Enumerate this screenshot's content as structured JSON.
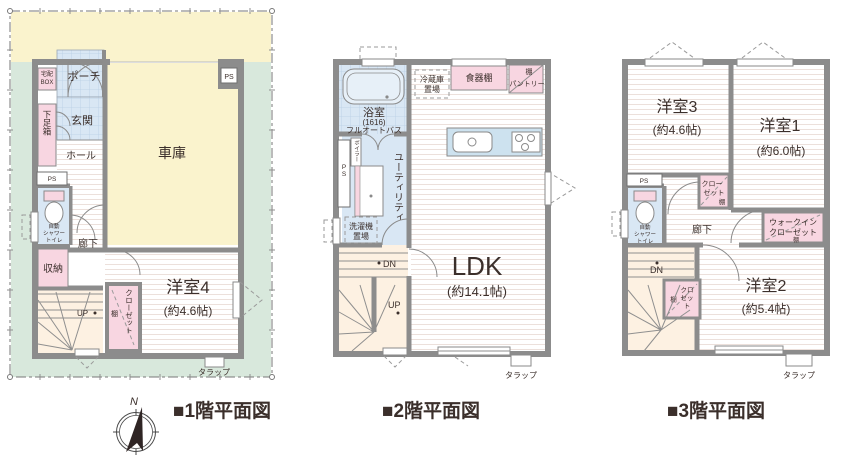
{
  "page": {
    "type": "floor-plan-sheet",
    "background": "#ffffff"
  },
  "colors": {
    "yard_yellow": "#faf3cd",
    "yard_green": "#d8e8dc",
    "garage_yellow": "#faf3cd",
    "tile_blue": "#d9e7f4",
    "fixture_blue": "#cde2ef",
    "pink": "#f8d6e1",
    "stair_cream": "#fdf1e2",
    "wall_gray": "#8c8c8c",
    "text_dark": "#3b2f2b"
  },
  "captions": {
    "floor1": "■1階平面図",
    "floor2": "■2階平面図",
    "floor3": "■3階平面図"
  },
  "compass": {
    "north_label": "N"
  },
  "floor1": {
    "labels": {
      "delivery_l1": "宅配",
      "delivery_l2": "BOX",
      "porch": "ポーチ",
      "entrance": "玄関",
      "shoe_cabinet": "下足箱",
      "hall": "ホール",
      "ps_garage": "PS",
      "garage": "車庫",
      "ps_left": "PS",
      "toilet_l1": "自動",
      "toilet_l2": "シャワー",
      "toilet_l3": "トイレ",
      "corridor": "廊下",
      "storage": "収納",
      "up": "UP",
      "closet": "クローゼット",
      "closet_shelf": "棚",
      "room4": "洋室4",
      "room4_size": "(約4.6帖)",
      "tarappu": "タラップ"
    }
  },
  "floor2": {
    "labels": {
      "bath": "浴室",
      "bath_size": "(1616)",
      "bath_type": "フルオートバス",
      "fridge_l1": "冷蔵庫",
      "fridge_l2": "置場",
      "cupboard": "食器棚",
      "shelf": "棚",
      "pantry": "パントリー",
      "boiler": "ボイラー",
      "ps": "PS",
      "utility": "ユーティリティ",
      "washer_l1": "洗濯機",
      "washer_l2": "置場",
      "dn": "DN",
      "up": "UP",
      "ldk": "LDK",
      "ldk_size": "(約14.1帖)",
      "tarappu": "タラップ"
    }
  },
  "floor3": {
    "labels": {
      "room3": "洋室3",
      "room3_size": "(約4.6帖)",
      "room1": "洋室1",
      "room1_size": "(約6.0帖)",
      "ps": "PS",
      "closet1_l1": "クロー",
      "closet1_l2": "ゼット",
      "closet1_shelf": "棚",
      "toilet_l1": "自動",
      "toilet_l2": "シャワー",
      "toilet_l3": "トイレ",
      "corridor": "廊下",
      "wic_l1": "ウォークイン",
      "wic_l2": "クローゼット",
      "wic_shelf": "棚",
      "dn": "DN",
      "closet2_l1": "クロ",
      "closet2_l2": "ゼッ",
      "closet2_l3": "ト",
      "closet2_shelf": "棚",
      "room2": "洋室2",
      "room2_size": "(約5.4帖)",
      "tarappu": "タラップ"
    }
  }
}
